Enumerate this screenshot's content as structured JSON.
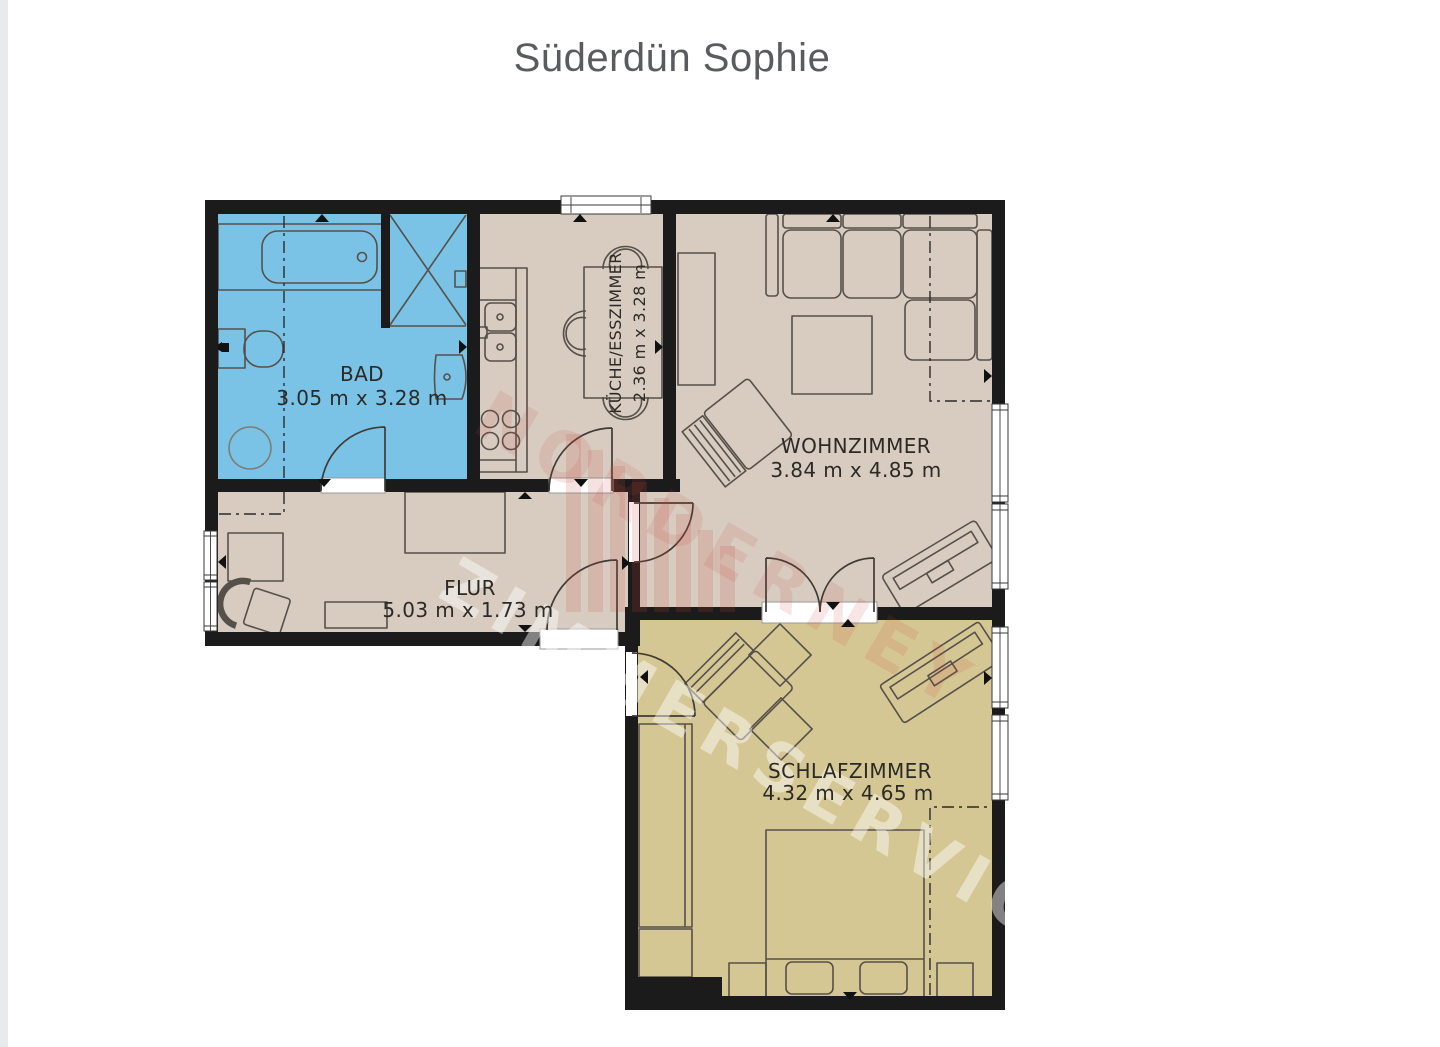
{
  "page": {
    "title_label": "Süderdün Sophie"
  },
  "colors": {
    "wall": "#1b1b1b",
    "floor_main": "#d8ccc1",
    "floor_bad": "#7ac3e6",
    "floor_schlaf": "#d5c794",
    "furniture_stroke": "#56504a",
    "label_text": "#2b2a26",
    "watermark_red": "#c7463c",
    "watermark_white": "#ffffff",
    "title_text": "#595b5e"
  },
  "rooms": {
    "bad": {
      "name": "BAD",
      "dims": "3.05 m x 3.28 m"
    },
    "kueche": {
      "name": "KÜCHE/ESSZIMMER",
      "dims": "2.36 m x 3.28 m"
    },
    "wohnzimmer": {
      "name": "WOHNZIMMER",
      "dims": "3.84 m x 4.85 m"
    },
    "flur": {
      "name": "FLUR",
      "dims": "5.03 m x 1.73 m"
    },
    "schlafzimmer": {
      "name": "SCHLAFZIMMER",
      "dims": "4.32 m x 4.65 m"
    }
  },
  "watermark": {
    "line1": "NORDERNEY",
    "line2": "ZIMMERSERVICE"
  }
}
